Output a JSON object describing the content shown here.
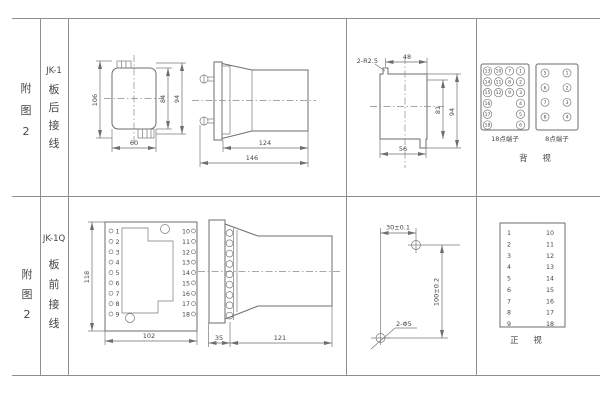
{
  "row1": {
    "figure_chars": [
      "附",
      "图",
      "2"
    ],
    "model": "JK-1",
    "wiring_chars": [
      "板",
      "后",
      "接",
      "线"
    ],
    "front_view": {
      "dim_overall_height": "106",
      "dim_inner_height": "84",
      "dim_mid_height": "94",
      "dim_width": "60"
    },
    "side_view": {
      "dim_body_length": "124",
      "dim_overall_length": "146"
    },
    "cutout_view": {
      "corner_note": "2-R2.5",
      "dim_width_top": "48",
      "dim_height_inner": "81",
      "dim_height_outer": "94",
      "dim_width_bottom": "56"
    },
    "terminals": {
      "block18_label": "18点端子",
      "block8_label": "8点端子",
      "view_label": "背 视",
      "block18": {
        "col1": [
          "13",
          "14",
          "15",
          "16",
          "17",
          "18"
        ],
        "col2": [
          "10",
          "11",
          "12"
        ],
        "col3": [
          "7",
          "8",
          "9"
        ],
        "col4": [
          "1",
          "2",
          "3",
          "4",
          "5",
          "6"
        ]
      },
      "block8": {
        "col1": [
          "5",
          "6",
          "7",
          "8"
        ],
        "col2": [
          "1",
          "2",
          "3",
          "4"
        ]
      }
    }
  },
  "row2": {
    "figure_chars": [
      "附",
      "图",
      "2"
    ],
    "model": "JK-1Q",
    "wiring_chars": [
      "板",
      "前",
      "接",
      "线"
    ],
    "front_view": {
      "dim_height": "118",
      "dim_width": "102",
      "left_terminals": [
        "1",
        "2",
        "3",
        "4",
        "5",
        "6",
        "7",
        "8",
        "9"
      ],
      "right_terminals": [
        "10",
        "11",
        "12",
        "13",
        "14",
        "15",
        "16",
        "17",
        "18"
      ]
    },
    "side_view": {
      "dim_flange": "35",
      "dim_body_length": "121"
    },
    "drill_view": {
      "dim_x": "30±0.1",
      "dim_y": "100±0.2",
      "hole_note": "2-Φ5"
    },
    "terminal_list": {
      "view_label": "正 视",
      "left": [
        "1",
        "2",
        "3",
        "4",
        "5",
        "6",
        "7",
        "8",
        "9"
      ],
      "right": [
        "10",
        "11",
        "12",
        "13",
        "14",
        "15",
        "16",
        "17",
        "18"
      ]
    }
  }
}
